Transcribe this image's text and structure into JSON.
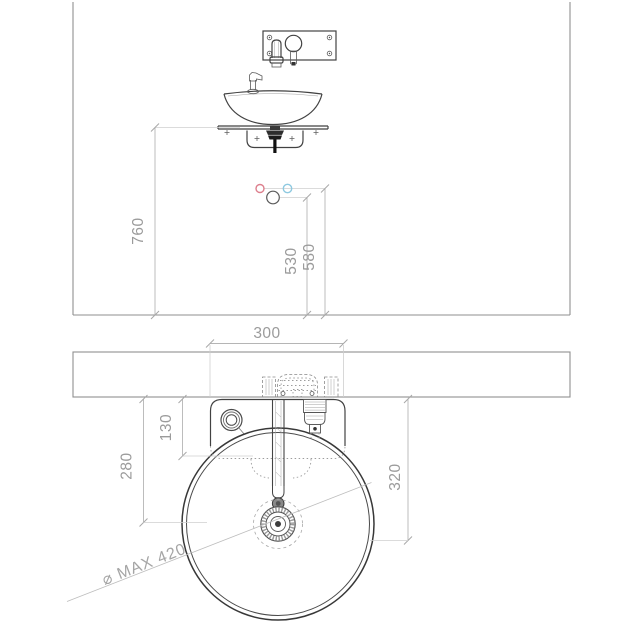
{
  "meta": {
    "title": "Vessel washbasin with wall-mounted mixer — installation drawing"
  },
  "colors": {
    "hot": "#dd7f8d",
    "cold": "#8ec9e0",
    "waste": "#5a5a5a"
  },
  "front_view": {
    "dims": {
      "floor_to_shelf": "760",
      "floor_to_waste": "530",
      "floor_to_supplies": "580"
    }
  },
  "plan_view": {
    "dims": {
      "mixer_width": "300",
      "wall_to_mixer_knob": "130",
      "wall_to_drain": "280",
      "wall_to_basin_front": "320",
      "basin_max_diameter": "⌀ MAX 420"
    }
  }
}
